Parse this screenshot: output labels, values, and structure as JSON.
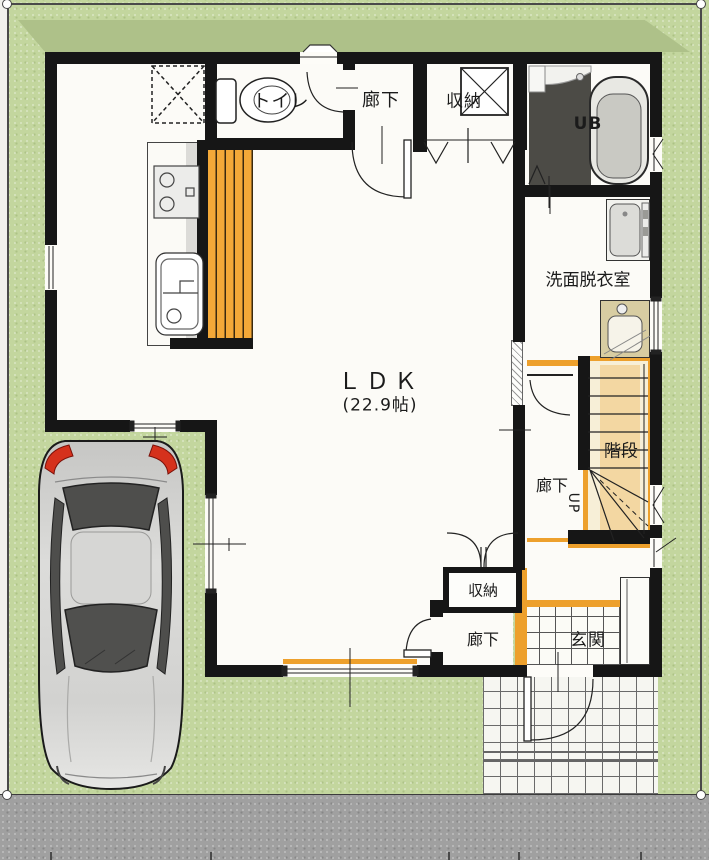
{
  "scene": {
    "type": "residential-floor-plan-first-floor",
    "labels": {
      "ldk": "ＬＤＫ",
      "ldk_area": "(22.9帖)",
      "toilet": "トイレ",
      "hallway_top": "廊下",
      "storage_top": "収納",
      "unit_bath": "UB",
      "washroom": "洗面脱衣室",
      "stairs": "階段",
      "hallway_mid": "廊下",
      "up_direction": "UP",
      "storage_bottom": "収納",
      "hallway_bottom": "廊下",
      "entrance": "玄関"
    },
    "colors": {
      "lawn": "#c3d69e",
      "lawn_shadow": "#aec189",
      "road": "#a0a0a0",
      "wall": "#161616",
      "floor": "#fcfbf7",
      "wood_accent": "#eda02c",
      "stair_floor": "#f7efd7",
      "stair_inner": "#f3d7a2",
      "bath_floor": "#4c4b46",
      "vanity": "#d8cda2",
      "car_body": "#cfcfcd",
      "taillight": "#d5311c"
    }
  }
}
